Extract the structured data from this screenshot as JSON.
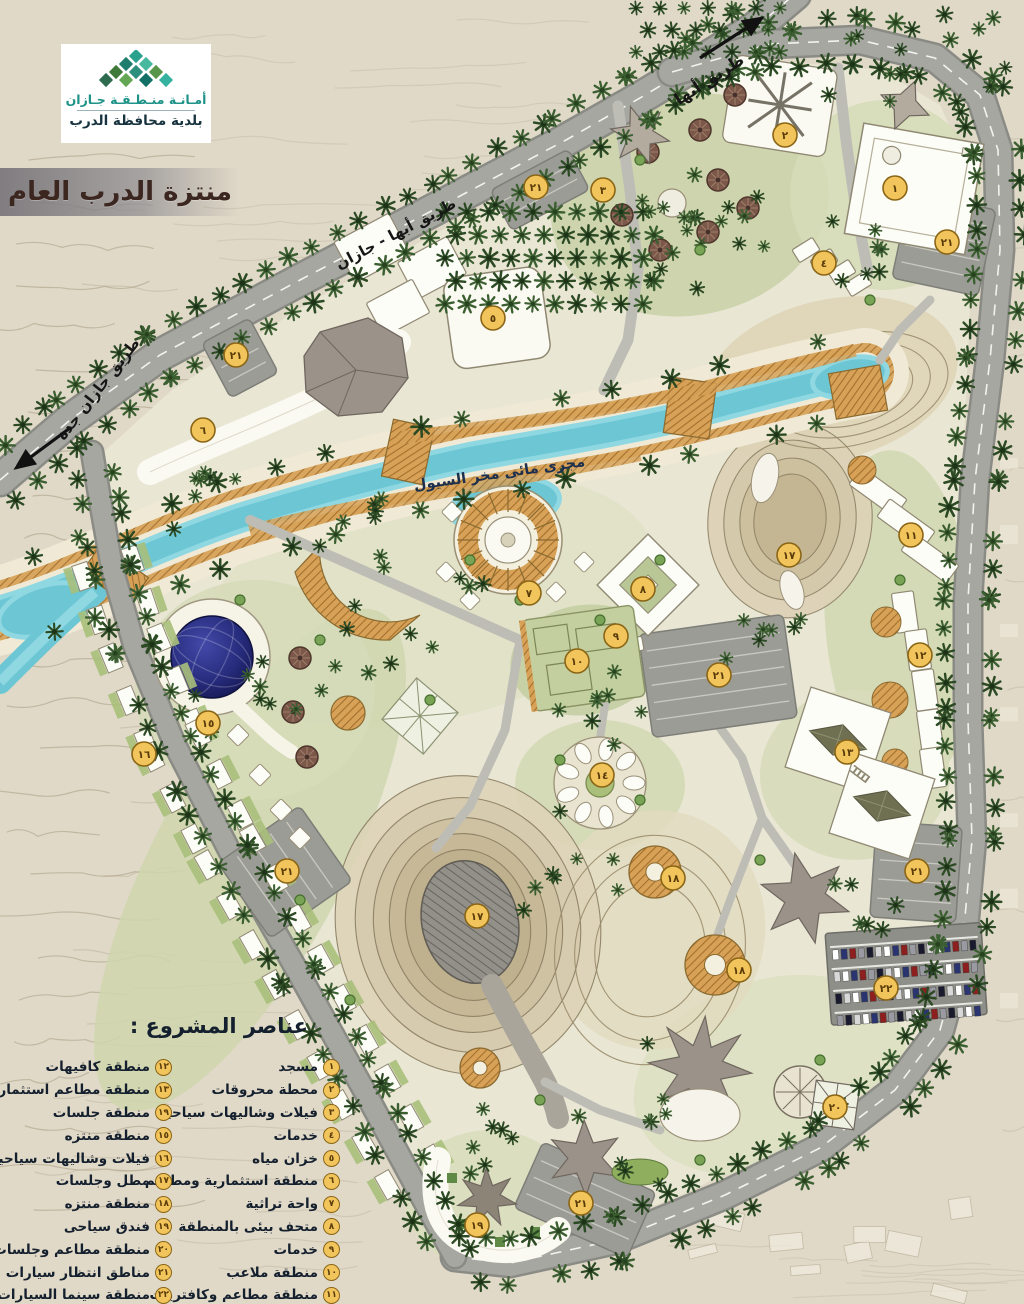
{
  "header": {
    "logo": {
      "line1": "أمـانـة منـطـقـة جـازان",
      "line2": "بلدية محافظة الدرب"
    },
    "title": "منتزة الدرب العام"
  },
  "map": {
    "road_labels": {
      "abha": "طريق أبها",
      "abha_jazan": "طريق أبها - جازان",
      "jazan_jeddah": "طريق جازان جدة"
    },
    "wadi_label": "مجرى مائى مخر السيول",
    "markers": [
      {
        "num": "١",
        "x": 895,
        "y": 188
      },
      {
        "num": "٢",
        "x": 785,
        "y": 135
      },
      {
        "num": "٣",
        "x": 603,
        "y": 190
      },
      {
        "num": "٤",
        "x": 824,
        "y": 263
      },
      {
        "num": "٥",
        "x": 493,
        "y": 318
      },
      {
        "num": "٦",
        "x": 203,
        "y": 430
      },
      {
        "num": "٧",
        "x": 529,
        "y": 593
      },
      {
        "num": "٨",
        "x": 643,
        "y": 589
      },
      {
        "num": "٩",
        "x": 616,
        "y": 636
      },
      {
        "num": "١٠",
        "x": 577,
        "y": 661
      },
      {
        "num": "١١",
        "x": 911,
        "y": 535
      },
      {
        "num": "١٢",
        "x": 920,
        "y": 655
      },
      {
        "num": "١٣",
        "x": 847,
        "y": 752
      },
      {
        "num": "١٤",
        "x": 602,
        "y": 775
      },
      {
        "num": "١٥",
        "x": 208,
        "y": 723
      },
      {
        "num": "١٦",
        "x": 144,
        "y": 754
      },
      {
        "num": "١٧",
        "x": 789,
        "y": 555
      },
      {
        "num": "١٧",
        "x": 477,
        "y": 916
      },
      {
        "num": "١٨",
        "x": 673,
        "y": 878
      },
      {
        "num": "١٨",
        "x": 739,
        "y": 970
      },
      {
        "num": "١٩",
        "x": 477,
        "y": 1225
      },
      {
        "num": "٢٠",
        "x": 835,
        "y": 1107
      },
      {
        "num": "٢١",
        "x": 536,
        "y": 187
      },
      {
        "num": "٢١",
        "x": 947,
        "y": 242
      },
      {
        "num": "٢١",
        "x": 236,
        "y": 355
      },
      {
        "num": "٢١",
        "x": 719,
        "y": 675
      },
      {
        "num": "٢١",
        "x": 287,
        "y": 871
      },
      {
        "num": "٢١",
        "x": 917,
        "y": 871
      },
      {
        "num": "٢١",
        "x": 581,
        "y": 1203
      },
      {
        "num": "٢٢",
        "x": 886,
        "y": 988
      }
    ]
  },
  "legend": {
    "title": "عناصر المشروع :",
    "col_right": [
      {
        "num": "١",
        "label": "مسجد"
      },
      {
        "num": "٢",
        "label": "محطة محروقات"
      },
      {
        "num": "٣",
        "label": "فيلات وشاليهات سياحية"
      },
      {
        "num": "٤",
        "label": "خدمات"
      },
      {
        "num": "٥",
        "label": "خزان مياه"
      },
      {
        "num": "٦",
        "label": "منطقة استثمارية ومطاعم"
      },
      {
        "num": "٧",
        "label": "واحة تراثية"
      },
      {
        "num": "٨",
        "label": "متحف بيئى بالمنطقة"
      },
      {
        "num": "٩",
        "label": "خدمات"
      },
      {
        "num": "١٠",
        "label": "منطقة ملاعب"
      },
      {
        "num": "١١",
        "label": "منطقة مطاعم وكافتريات"
      }
    ],
    "col_left": [
      {
        "num": "١٢",
        "label": "منطقة كافيهات"
      },
      {
        "num": "١٣",
        "label": "منطقة مطاعم استثمارية"
      },
      {
        "num": "١٩",
        "label": "منطقة جلسات"
      },
      {
        "num": "١٥",
        "label": "منطقة منتزه"
      },
      {
        "num": "١٦",
        "label": "فيلات وشاليهات سياحية"
      },
      {
        "num": "١٧",
        "label": "مطل وجلسات"
      },
      {
        "num": "١٨",
        "label": "منطقة منتزه"
      },
      {
        "num": "١٩",
        "label": "فندق سياحى"
      },
      {
        "num": "٢٠",
        "label": "منطقة مطاعم وجلسات"
      },
      {
        "num": "٢١",
        "label": "مناطق انتظار سيارات"
      },
      {
        "num": "٢٢",
        "label": "منطقة سينما السيارات"
      }
    ]
  },
  "colors": {
    "marker_fill": "#f2c55c",
    "marker_border": "#8a6516",
    "marker_text": "#5a3c0a",
    "water": "#6cc6d4",
    "bank_hatch": "#d7a258",
    "road": "#a7a7a2",
    "title_color": "#3c2620",
    "logo_teal": "#1d9387",
    "dome_blue": "#272c7d"
  }
}
